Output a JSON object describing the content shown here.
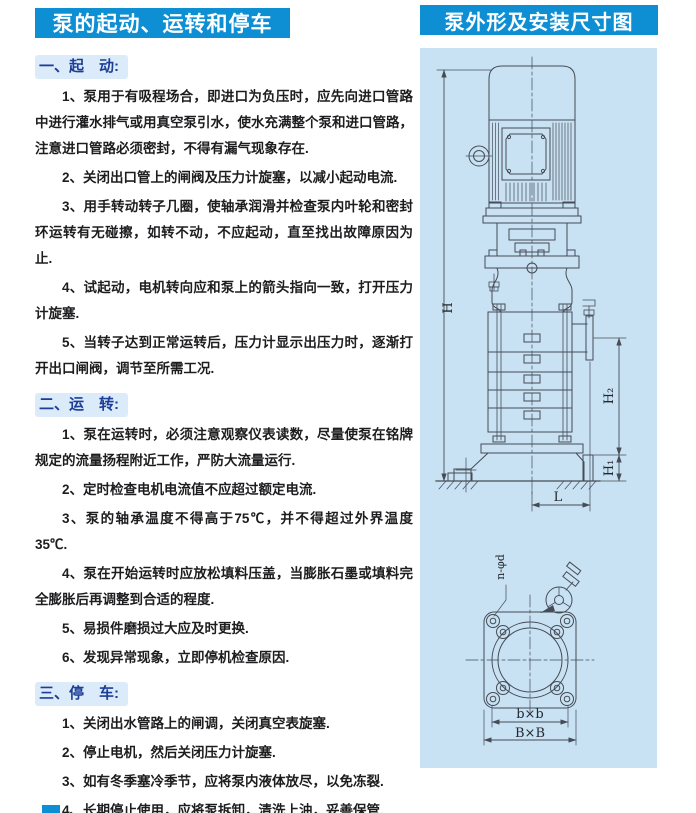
{
  "colors": {
    "header_blue": "#0e8fd4",
    "panel_blue": "#c8e1f3",
    "heading_navy": "#1c3e96",
    "heading_bg": "#dcebf9",
    "line_color": "#454c55"
  },
  "left": {
    "title": "泵的起动、运转和停车",
    "sections": [
      {
        "heading": "一、起　动:",
        "items": [
          "1、泵用于有吸程场合，即进口为负压时，应先向进口管路中进行灌水排气或用真空泵引水，使水充满整个泵和进口管路，注意进口管路必须密封，不得有漏气现象存在.",
          "2、关闭出口管上的闸阀及压力计旋塞，以减小起动电流.",
          "3、用手转动转子几圈，使轴承润滑并检查泵内叶轮和密封环运转有无碰擦，如转不动，不应起动，直至找出故障原因为止.",
          "4、试起动，电机转向应和泵上的箭头指向一致，打开压力计旋塞.",
          "5、当转子达到正常运转后，压力计显示出压力时，逐渐打开出口闸阀，调节至所需工况."
        ]
      },
      {
        "heading": "二、运　转:",
        "items": [
          "1、泵在运转时，必须注意观察仪表读数，尽量使泵在铭牌规定的流量扬程附近工作，严防大流量运行.",
          "2、定时检查电机电流值不应超过额定电流.",
          "3、泵的轴承温度不得高于75℃，并不得超过外界温度35℃.",
          "4、泵在开始运转时应放松填料压盖，当膨胀石墨或填料完全膨胀后再调整到合适的程度.",
          "5、易损件磨损过大应及时更换.",
          "6、发现异常现象，立即停机检查原因."
        ]
      },
      {
        "heading": "三、停　车:",
        "items": [
          "1、关闭出水管路上的闸调，关闭真空表旋塞.",
          "2、停止电机，然后关闭压力计旋塞.",
          "3、如有冬季塞冷季节，应将泵内液体放尽，以免冻裂.",
          "4、长期停止使用，应将泵拆卸，清洗上油，妥善保管."
        ]
      }
    ]
  },
  "right": {
    "title": "泵外形及安装尺寸图",
    "dims": {
      "H": "H",
      "H2": "H₂",
      "H1": "H₁",
      "L": "L",
      "bolt_spec": "n-φd",
      "bxb": "b×b",
      "BxB": "B×B"
    }
  }
}
